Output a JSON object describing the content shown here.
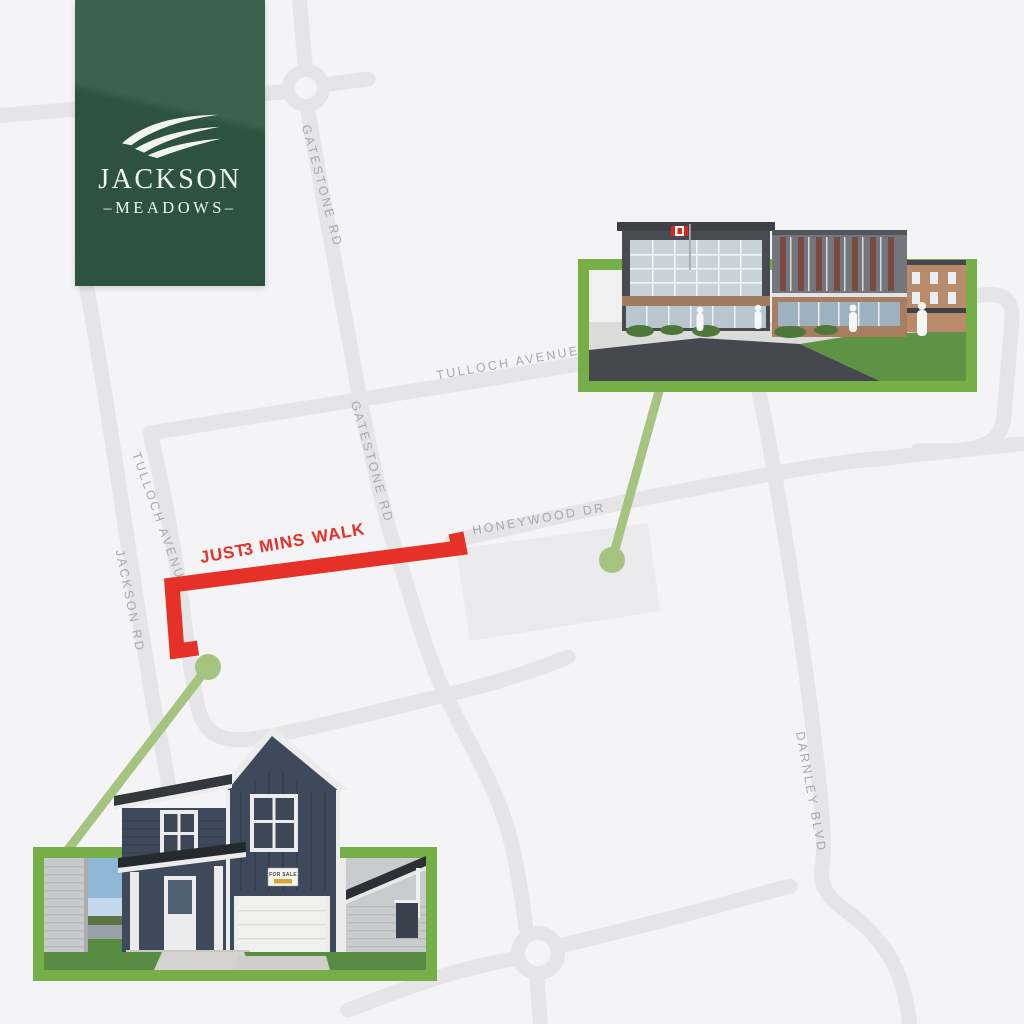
{
  "logo": {
    "title": "JACKSON",
    "subtitle": "–MEADOWS–"
  },
  "colors": {
    "background": "#f4f4f6",
    "road": "#e5e5e8",
    "parcel": "#eaeaed",
    "road_label": "#a9a9ad",
    "route_red": "#e63128",
    "marker_green": "#a5c47f",
    "frame_green": "#76ae48",
    "logo_green_dark": "#2d5241",
    "logo_green_light": "#3c624f"
  },
  "map": {
    "roads": [
      {
        "id": "gatestone-rd-north",
        "label": "GATESTONE RD"
      },
      {
        "id": "tulloch-avenue-east",
        "label": "TULLOCH AVENUE"
      },
      {
        "id": "gatestone-rd-mid",
        "label": "GATESTONE RD"
      },
      {
        "id": "honeywood-dr",
        "label": "HONEYWOOD DR"
      },
      {
        "id": "tulloch-avenue-south",
        "label": "TULLOCH AVENUE"
      },
      {
        "id": "jackson-rd",
        "label": "JACKSON RD"
      },
      {
        "id": "darnley-blvd",
        "label": "DARNLEY BLVD"
      }
    ]
  },
  "route": {
    "label_part1": "JUST",
    "label_part2": "3 MINS",
    "label_part3": "WALK"
  },
  "photos": {
    "house_sign": "FOR SALE"
  }
}
